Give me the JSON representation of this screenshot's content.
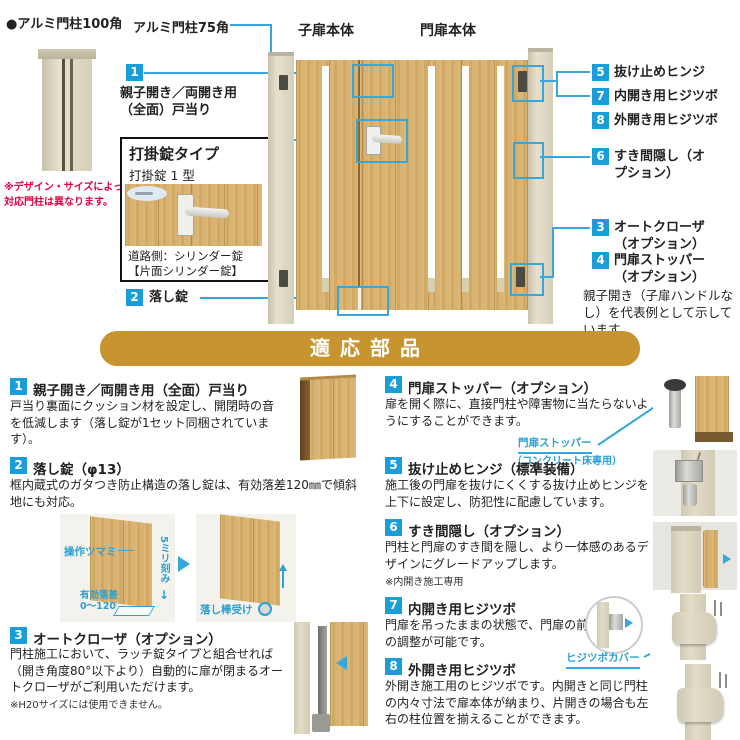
{
  "colors": {
    "badge_blue": "#1b9dd9",
    "line_blue": "#35a7da",
    "banner_gold": "#c8942f",
    "warning_red": "#e50044",
    "wood": "#d9b373",
    "post_beige": "#ddd7c3"
  },
  "diagram": {
    "post100": {
      "label": "●アルミ門柱100角",
      "note": "※デザイン・サイズによって\n対応門柱は異なります。"
    },
    "pillar75_label": "アルミ門柱75角",
    "child_door_label": "子扉本体",
    "main_door_label": "門扉本体",
    "callout1": {
      "num": "1",
      "label": "親子開き／両開き用\n（全面）戸当り"
    },
    "lockbox": {
      "title": "打掛錠タイプ",
      "subtitle": "打掛錠 1 型",
      "caption": "道路側：シリンダー錠\n【片面シリンダー錠】"
    },
    "callout2": {
      "num": "2",
      "label": "落し錠"
    },
    "right_callouts": [
      {
        "num": "5",
        "label": "抜け止めヒンジ"
      },
      {
        "num": "7",
        "label": "内開き用ヒジツボ"
      },
      {
        "num": "8",
        "label": "外開き用ヒジツボ"
      },
      {
        "num": "6",
        "label": "すき間隠し（オプション）"
      },
      {
        "num": "3",
        "label": "オートクローザ（オプション）"
      },
      {
        "num": "4",
        "label": "門扉ストッパー（オプション）"
      }
    ],
    "note": "親子開き（子扉ハンドルなし）を代表例として示しています。"
  },
  "banner": {
    "title": "適応部品"
  },
  "items": [
    {
      "num": "1",
      "title": "親子開き／両開き用（全面）戸当り",
      "body": "戸当り裏面にクッション材を設定し、開閉時の音を低減します（落し錠が1セット同梱されています）。"
    },
    {
      "num": "2",
      "title": "落し錠（φ13）",
      "body": "框内蔵式のガタつき防止構造の落し錠は、有効落差120㎜で傾斜地にも対応。",
      "ann_knob": "操作ツマミ",
      "ann_pitch": "5ミリ刻み",
      "ann_drop": "有効落差\n0〜120",
      "ann_receiver": "落し棒受け"
    },
    {
      "num": "3",
      "title": "オートクローザ（オプション）",
      "body": "門柱施工において、ラッチ錠タイプと組合せれば（開き角度80°以下より）自動的に扉が閉まるオートクローザがご利用いただけます。",
      "note": "※H20サイズには使用できません。"
    },
    {
      "num": "4",
      "title": "門扉ストッパー（オプション）",
      "body": "扉を開く際に、直接門柱や障害物に当たらないようにすることができます。",
      "ann1": "門扉ストッパー",
      "ann2": "（コンクリート床専用）"
    },
    {
      "num": "5",
      "title": "抜け止めヒンジ（標準装備）",
      "body": "施工後の門扉を抜けにくくする抜け止めヒンジを上下に設定し、防犯性に配慮しています。"
    },
    {
      "num": "6",
      "title": "すき間隠し（オプション）",
      "body": "門柱と門扉のすき間を隠し、より一体感のあるデザインにグレードアップします。",
      "note": "※内開き施工専用"
    },
    {
      "num": "7",
      "title": "内開き用ヒジツボ",
      "body": "門扉を吊ったままの状態で、門扉の前後左右の調整が可能です。",
      "ann1": "ヒジツボカバー"
    },
    {
      "num": "8",
      "title": "外開き用ヒジツボ",
      "body": "外開き施工用のヒジツボです。内開きと同じ門柱の内々寸法で扉本体が納まり、片開きの場合も左右の柱位置を揃えることができます。"
    }
  ]
}
